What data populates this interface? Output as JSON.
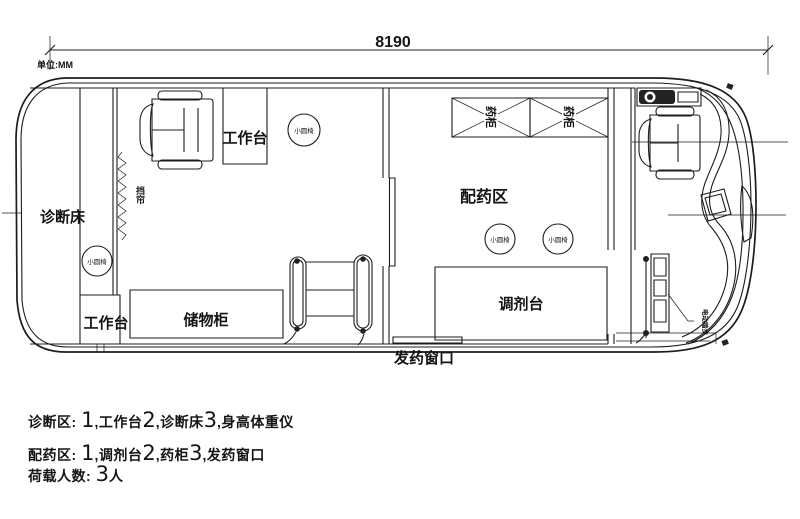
{
  "dimension": {
    "length_label": "8190",
    "unit_label": "单位:MM"
  },
  "diagnosis_room": {
    "bed": "诊断床",
    "curtain": "挡帘",
    "workbench_top": "工作台",
    "workbench_bottom": "工作台",
    "storage_cabinet": "储物柜",
    "stool": "小圆椅"
  },
  "pharmacy_room": {
    "name": "配药区",
    "medicine_cabinet": "药柜",
    "dispensing_table": "调剂台",
    "dispensing_window": "发药窗口",
    "stool": "小圆椅"
  },
  "cab": {
    "boarding_step": "电动踏步"
  },
  "notes": [
    [
      "诊断区: ",
      "1",
      ",工作台",
      "2",
      ",诊断床",
      "3",
      ",身高体重仪"
    ],
    [
      "配药区: ",
      "1",
      ",调剂台",
      "2",
      ",药柜",
      "3",
      ",发药窗口"
    ],
    [
      "荷载人数: ",
      "3",
      "人"
    ]
  ]
}
